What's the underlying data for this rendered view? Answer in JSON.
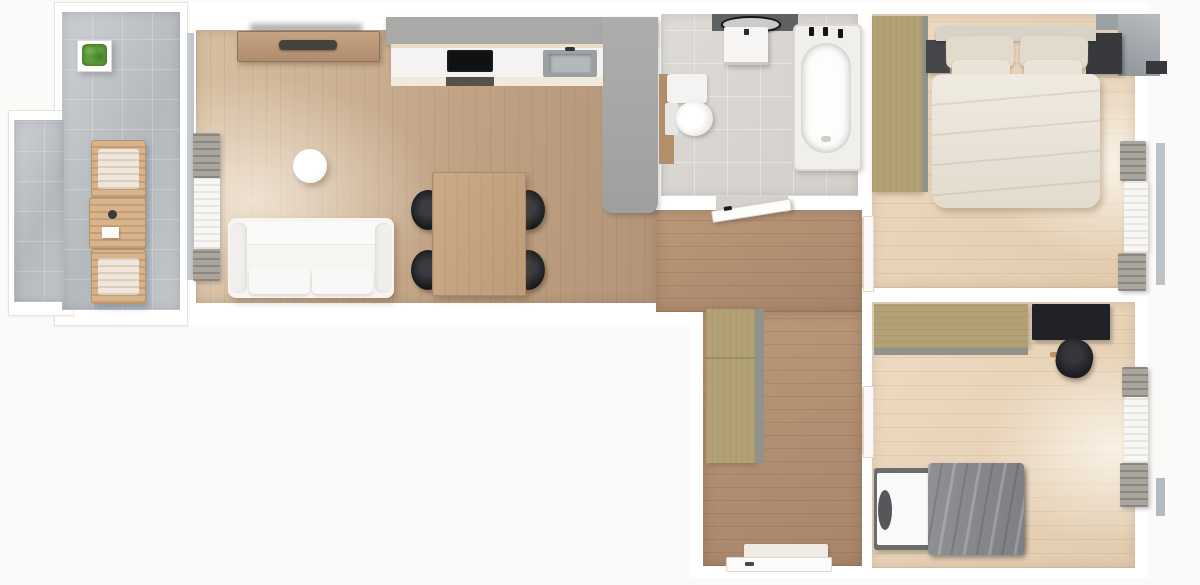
{
  "title": "3D top-down apartment floor plan render",
  "view": "top-down orthographic 3D render, no text labels",
  "colors": {
    "page-bg": "#fbfaf8",
    "wall": "#ffffff",
    "wall-line": "#e6e2dc",
    "wood-living": "#c3a485",
    "wood-hall": "#ad8a6c",
    "wood-bedroom": "#e6d2b8",
    "balcony-tile": "#b9bec3",
    "bath-tile": "#d8d5d0",
    "cabinet-gray": "#a9a9a7",
    "wardrobe-tan": "#b2a175",
    "furniture-dark": "#212225",
    "textile-white": "#f6f5f2",
    "duvet-cream": "#eae3d6",
    "blanket-gray": "#85878a",
    "plant-green": "#5d9a3c",
    "outdoor-wood": "#d8b48d",
    "accent-wall-dark": "#5f6163"
  },
  "rooms": [
    {
      "name": "balcony",
      "floor": "gray tile",
      "furniture": [
        "potted-plant",
        "deck-chair",
        "outdoor-table",
        "deck-chair"
      ]
    },
    {
      "name": "living-room",
      "floor": "light oak planks",
      "furniture": [
        "tv-sideboard",
        "tv",
        "round-side-table",
        "white-sofa",
        "dining-table",
        "dining-chair x4",
        "balcony-window-curtains"
      ]
    },
    {
      "name": "kitchen",
      "floor": "light oak planks",
      "furniture": [
        "upper-cabinet-run",
        "countertop",
        "cooktop",
        "sink",
        "tall-cabinet-column"
      ]
    },
    {
      "name": "bathroom",
      "floor": "light gray tile",
      "furniture": [
        "dark-accent-wall",
        "round-mirror",
        "vanity-basin",
        "bathtub",
        "toilet",
        "open-door"
      ]
    },
    {
      "name": "hallway",
      "floor": "walnut planks",
      "furniture": [
        "tall-wardrobe",
        "doormat",
        "entrance-door"
      ]
    },
    {
      "name": "bedroom-master",
      "floor": "pale oak planks",
      "furniture": [
        "wardrobe",
        "double-bed",
        "pillows x4",
        "nightstand x2",
        "wall-tv",
        "window-curtains"
      ]
    },
    {
      "name": "bedroom-second",
      "floor": "pale oak planks",
      "furniture": [
        "wardrobe",
        "desk",
        "office-chair",
        "single-bed",
        "gray-blanket",
        "window-curtains"
      ]
    }
  ]
}
